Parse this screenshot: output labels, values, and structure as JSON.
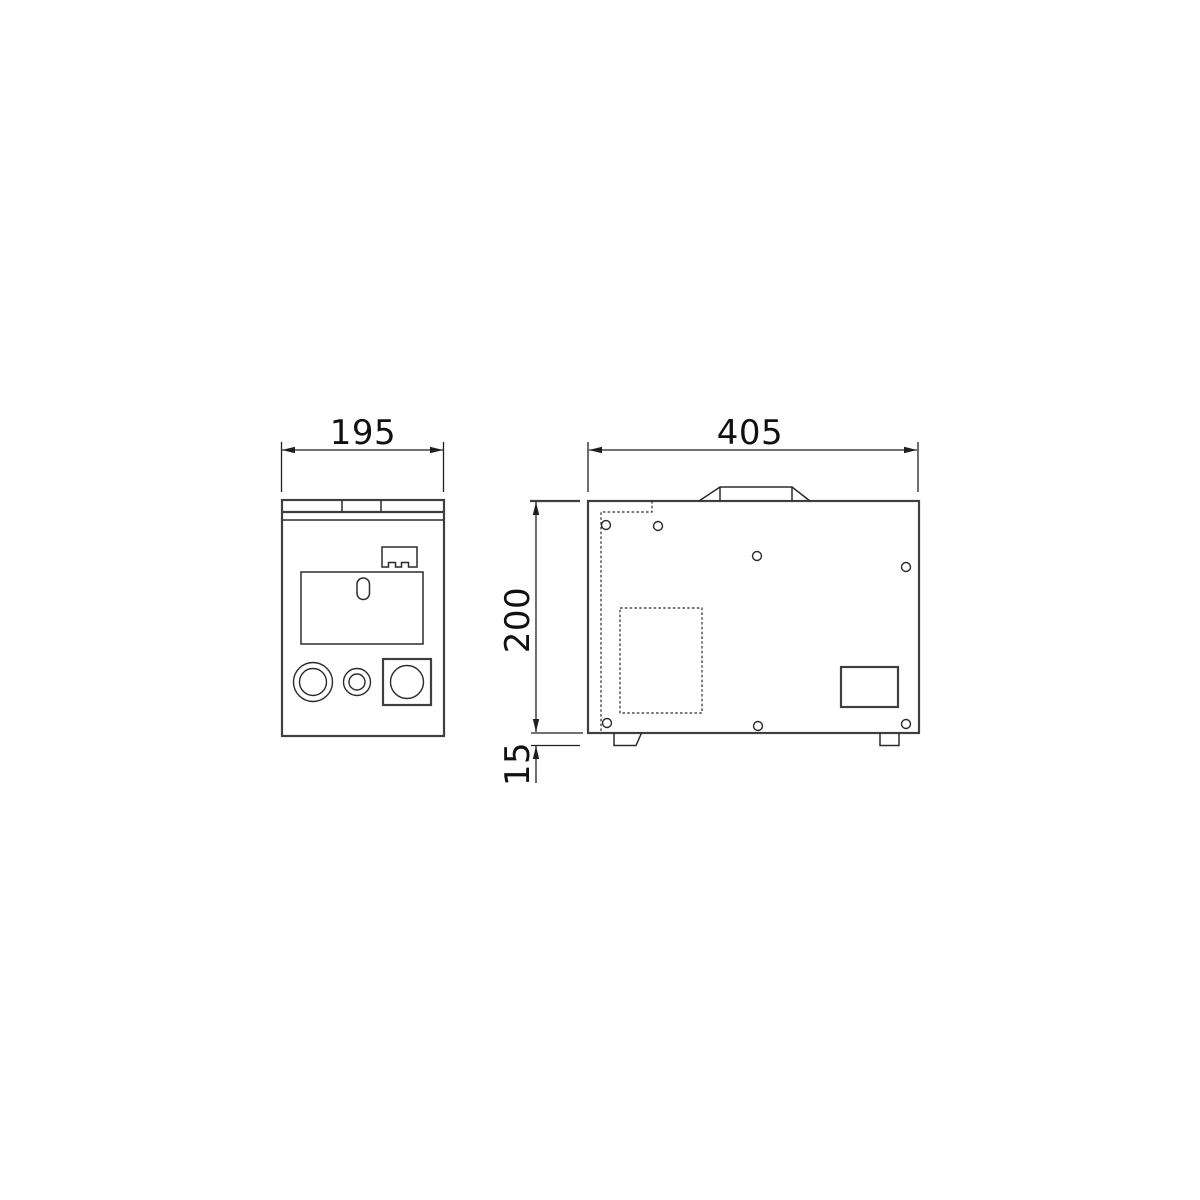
{
  "drawing": {
    "type": "technical-dimension-drawing",
    "views": {
      "front": "front-view",
      "side": "side-view"
    },
    "dimensions": {
      "front_width": "195",
      "side_width": "405",
      "side_height": "200",
      "foot_height": "15"
    },
    "colors": {
      "background": "#ffffff",
      "line": "#3f3f3f",
      "thin_line": "#2b2b2b",
      "dim_line": "#1f1f1f",
      "text": "#111111"
    }
  }
}
